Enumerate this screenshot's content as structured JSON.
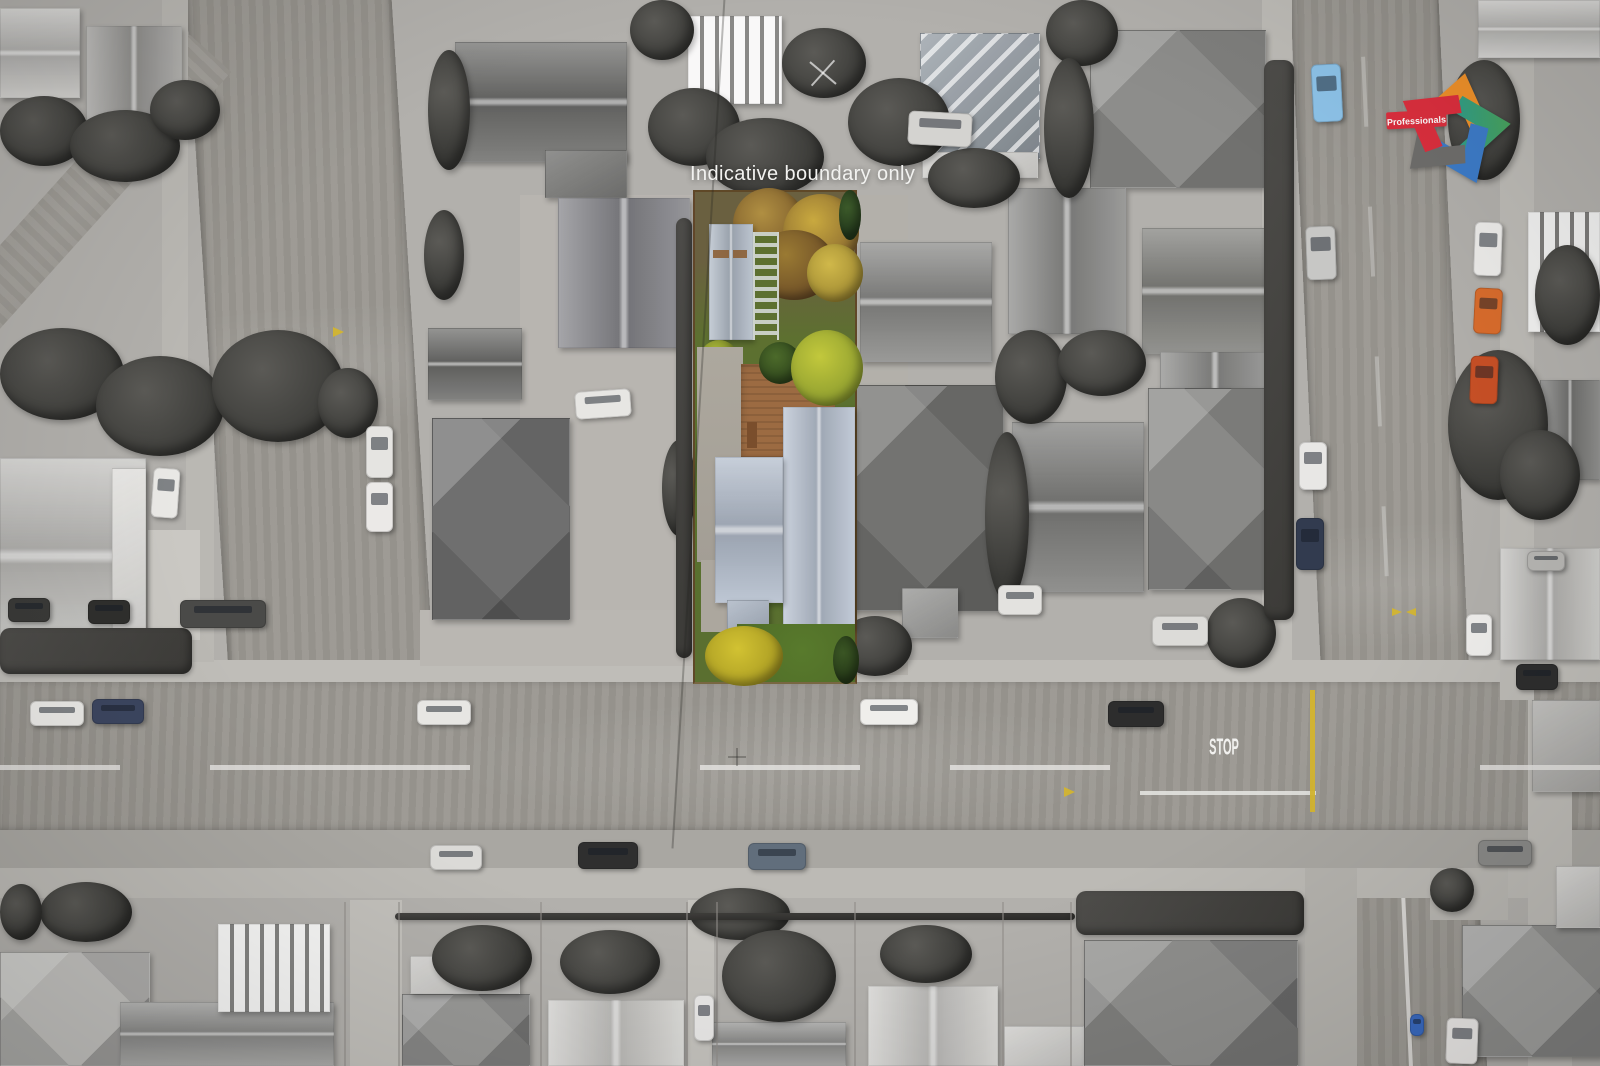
{
  "overlay": {
    "boundary_note": "Indicative boundary only"
  },
  "logo": {
    "brand": "Professionals"
  },
  "road_markings": {
    "stop": "STOP"
  },
  "colors": {
    "text_white": "#f2f2f0",
    "highlight_lawn": "#5d7030",
    "highlight_lawn_front": "#4f6b28",
    "highlight_roof": "#b7c1d0",
    "highlight_roof_wing": "#b3bdcc",
    "highlight_deck": "#9c6b42",
    "highlight_autumn": "#b08f42",
    "highlight_autumn_dark": "#6b4c26",
    "highlight_tree_bright": "#c2c83c",
    "highlight_tree_yellow": "#d2c232",
    "highlight_shed": "#b0bac6",
    "marking_yellow": "#d4b52e",
    "car_blue": "#8ec4ea",
    "car_orange": "#d96c2c",
    "car_orange_dark": "#c85026",
    "bin_blue": "#3a6ac0",
    "logo_red": "#dd2f3e",
    "logo_orange": "#f0912a",
    "logo_green": "#4aa45c",
    "logo_teal": "#2f9e8c",
    "logo_blue": "#3d7cc9",
    "logo_gray": "#6f6e6c"
  }
}
